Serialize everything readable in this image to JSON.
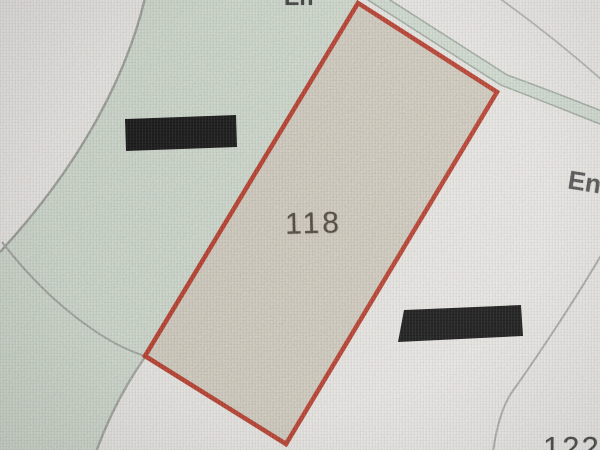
{
  "map": {
    "labels": {
      "parcel_number": "118",
      "street_right_partial": "En",
      "street_top_partial": "En",
      "parcel_bottom_right_partial": "122"
    }
  },
  "colors": {
    "background": "#e8e6e2",
    "green_area": "#cbd6c9",
    "parcel_fill": "#cdc7b9",
    "parcel_outline": "#b13a2b",
    "boundary_line": "#93968f",
    "inner_boundary_line": "#9a9d97",
    "road_fill": "#ccd8cb",
    "road_edge": "#9aa49a",
    "faint_line": "#abada8",
    "curve_line": "#a3a29e",
    "redaction": "#151515",
    "parcel_label_color": "#49413a",
    "street_label_color": "#4c4c4c",
    "top_label_color": "#3a3a3a",
    "bottom_label_color": "#3d3d3d"
  }
}
